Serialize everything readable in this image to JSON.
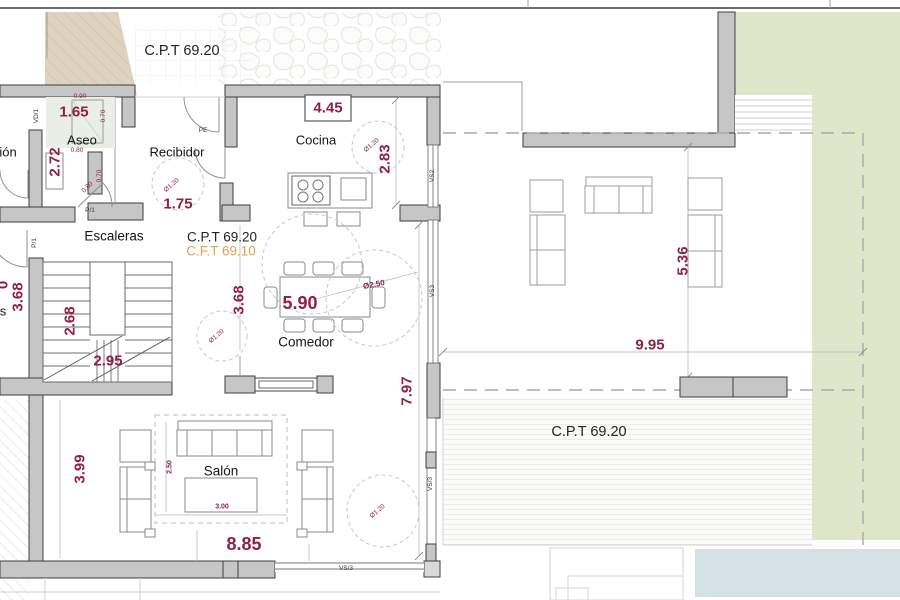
{
  "plan": {
    "title_labels": {
      "cpt_top": "C.P.T 69.20",
      "cpt_mid": "C.P.T 69.20",
      "cft_mid": "C.F.T 69.10",
      "cpt_terrace": "C.P.T 69.20"
    },
    "rooms": {
      "aseo": "Aseo",
      "recibidor": "Recibidor",
      "cocina": "Cocina",
      "escaleras": "Escaleras",
      "comedor": "Comedor",
      "salon": "Salón",
      "partial_left": "ión"
    },
    "dims": {
      "aseo_w": "1.65",
      "aseo_h": "2.72",
      "recibidor_d": "1.75",
      "cocina_w": "4.45",
      "cocina_h": "2.83",
      "left_h": "3.68",
      "stairs_h": "2.68",
      "stairs_w": "2.95",
      "stairs_r": "3.68",
      "comedor_w": "5.90",
      "comedor_dia": "Ø2.50",
      "east_h": "7.97",
      "salon_h": "3.99",
      "salon_w": "8.85",
      "salon_in_h": "2.50",
      "salon_in_w": "3.00",
      "terrace_h": "5.36",
      "terrace_w": "9.95",
      "circle_dia": "Ø1.20",
      "small_070": "0.70",
      "small_080": "0.80",
      "small_090": "0.90",
      "partial_0": "0",
      "partial_s": "s"
    },
    "tags": {
      "vd1": "VD/1",
      "pe": "PE",
      "p1": "P/1",
      "vs2": "VS2",
      "vs3": "VS3",
      "vs3_slash": "VS/3"
    },
    "colors": {
      "dimension_text": "#8e2140",
      "cft_label": "#e2a24a",
      "wall": "#c6c6c6",
      "lawn": "#e0e6c9",
      "pool": "#d3e1e5",
      "ramp": "#ded3bf"
    }
  }
}
